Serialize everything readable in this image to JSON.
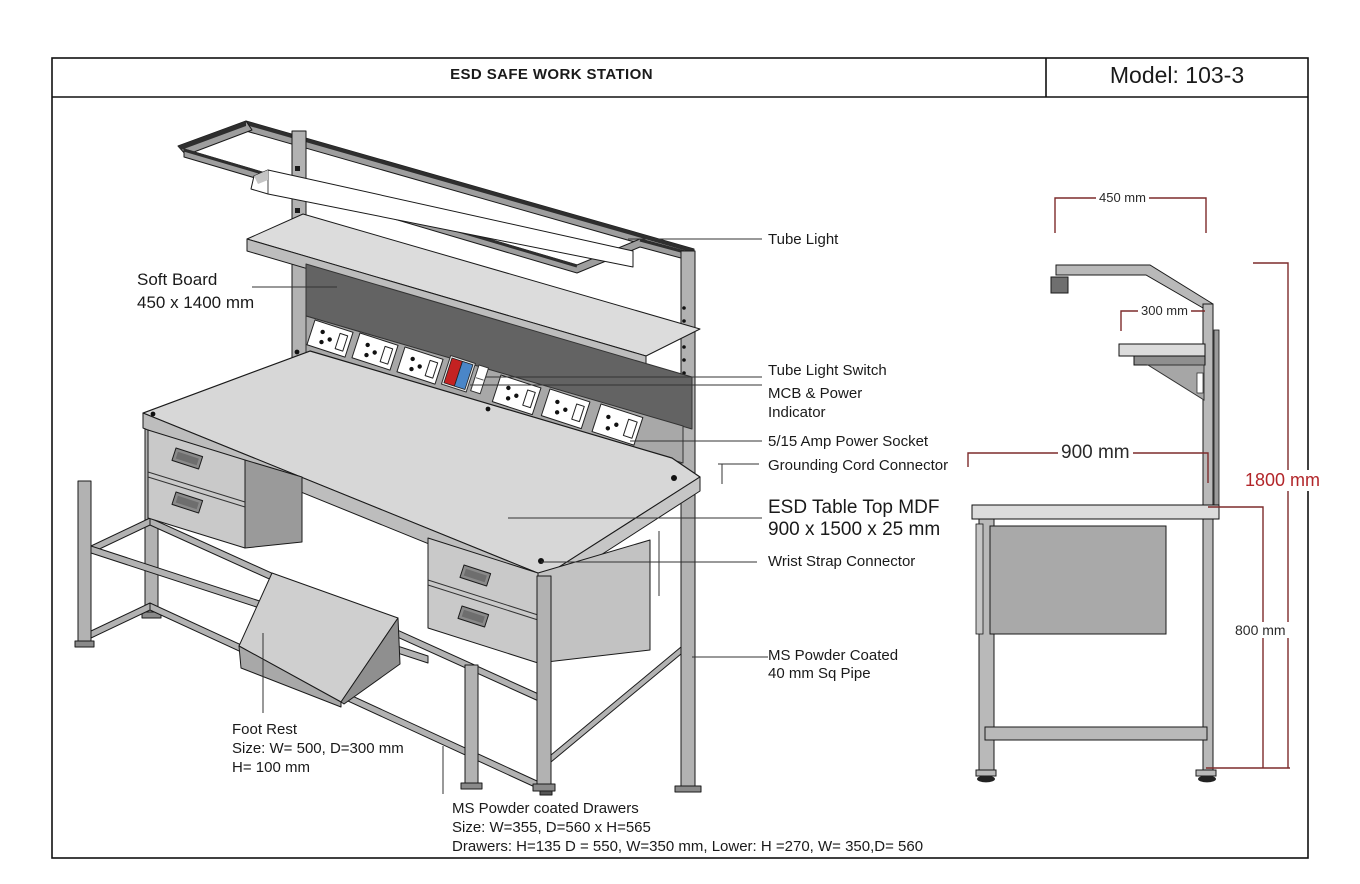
{
  "header": {
    "title": "ESD SAFE WORK STATION",
    "model": "Model: 103-3"
  },
  "callouts": {
    "soft_board_1": "Soft Board",
    "soft_board_2": "450 x 1400 mm",
    "tube_light": "Tube Light",
    "tube_light_switch": "Tube Light Switch",
    "mcb_1": "MCB & Power",
    "mcb_2": "Indicator",
    "power_socket": "5/15 Amp Power Socket",
    "grounding": "Grounding Cord Connector",
    "table_top_1": "ESD Table Top MDF",
    "table_top_2": "900 x 1500 x 25 mm",
    "wrist_strap": "Wrist Strap Connector",
    "pipe_1": "MS Powder Coated",
    "pipe_2": "40 mm Sq Pipe",
    "foot_rest_1": "Foot Rest",
    "foot_rest_2": "Size: W= 500, D=300 mm",
    "foot_rest_3": "H= 100 mm",
    "drawers_1": "MS Powder coated Drawers",
    "drawers_2": "Size: W=355, D=560 x H=565",
    "drawers_3": "Drawers: H=135 D = 550, W=350 mm, Lower: H =270, W= 350,D= 560"
  },
  "dimensions": {
    "overhang": "450 mm",
    "shelf_depth": "300 mm",
    "table_depth": "900 mm",
    "total_height": "1800 mm",
    "table_height": "800 mm"
  },
  "colors": {
    "dimension_line": "#7d2b2b",
    "dimension_text_red": "#b2262a",
    "soft_board": "#636363",
    "indicator_red": "#c42222",
    "indicator_blue": "#4a86c8",
    "structure_gray": "#b2b2b2"
  }
}
